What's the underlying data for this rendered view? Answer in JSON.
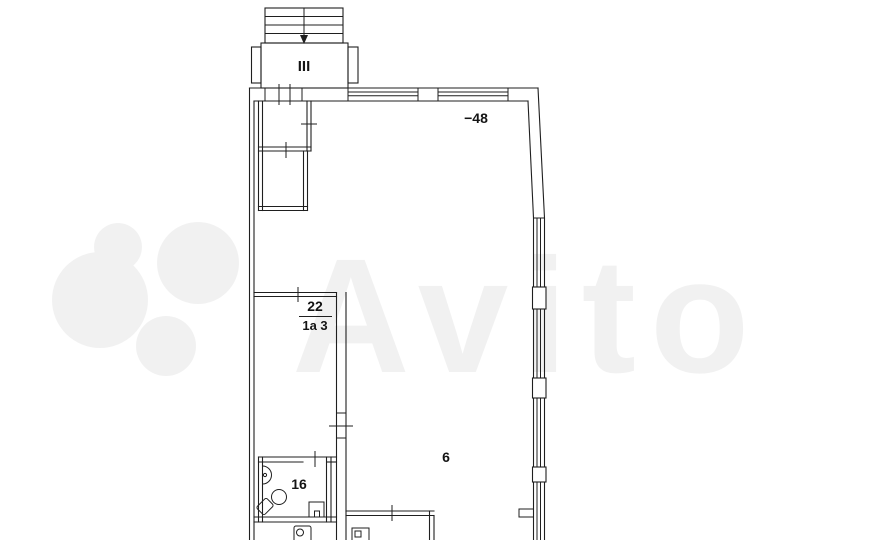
{
  "canvas": {
    "background": "#ffffff",
    "line_color": "#1f1f1f",
    "label_color": "#141414"
  },
  "watermark": {
    "text": "Avito",
    "opacity": "0.05"
  },
  "stairwell": {
    "label": "III"
  },
  "annotations": {
    "elevation_mark": "−48",
    "main_room": "6",
    "bathroom": "16",
    "closet_number": "22",
    "closet_detail": "1а 3"
  }
}
